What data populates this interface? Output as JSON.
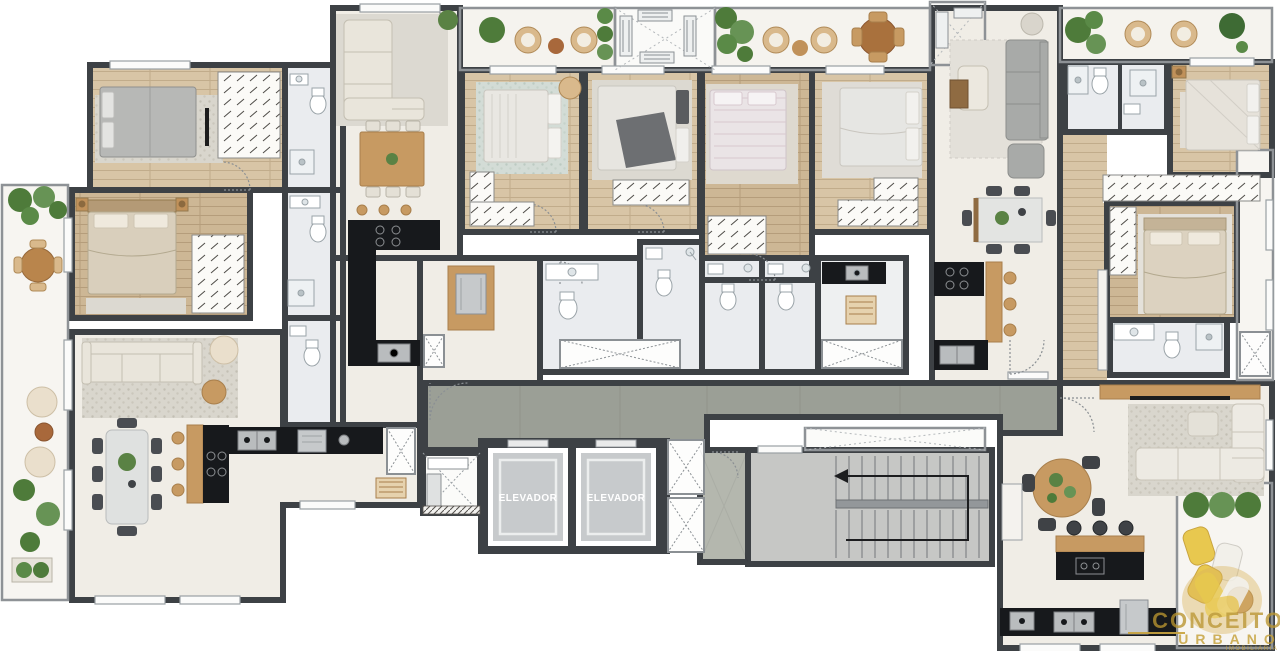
{
  "floor_plan": {
    "type": "residential-multi-unit-floor-plan",
    "elevator_labels": [
      "ELEVADOR",
      "ELEVADOR"
    ],
    "watermark": {
      "line1": "CONCEITO",
      "line2": "URBANO",
      "line3": "IMOBILIÁRIA"
    },
    "colors": {
      "wall": "#3d4145",
      "living_floor": "#f0ede6",
      "wood_floor": "#d8c5a6",
      "bath_floor": "#eaecef",
      "balcony_floor": "#f7f5f1",
      "corridor": "#9b9f96",
      "stair_concrete": "#c6c7c5",
      "elevator_cab": "#c7cacc",
      "counter_black": "#17191c",
      "wood_furniture": "#c0915a",
      "plant_green": "#4e7b3a",
      "logo_gold": "#c6a23c"
    }
  }
}
